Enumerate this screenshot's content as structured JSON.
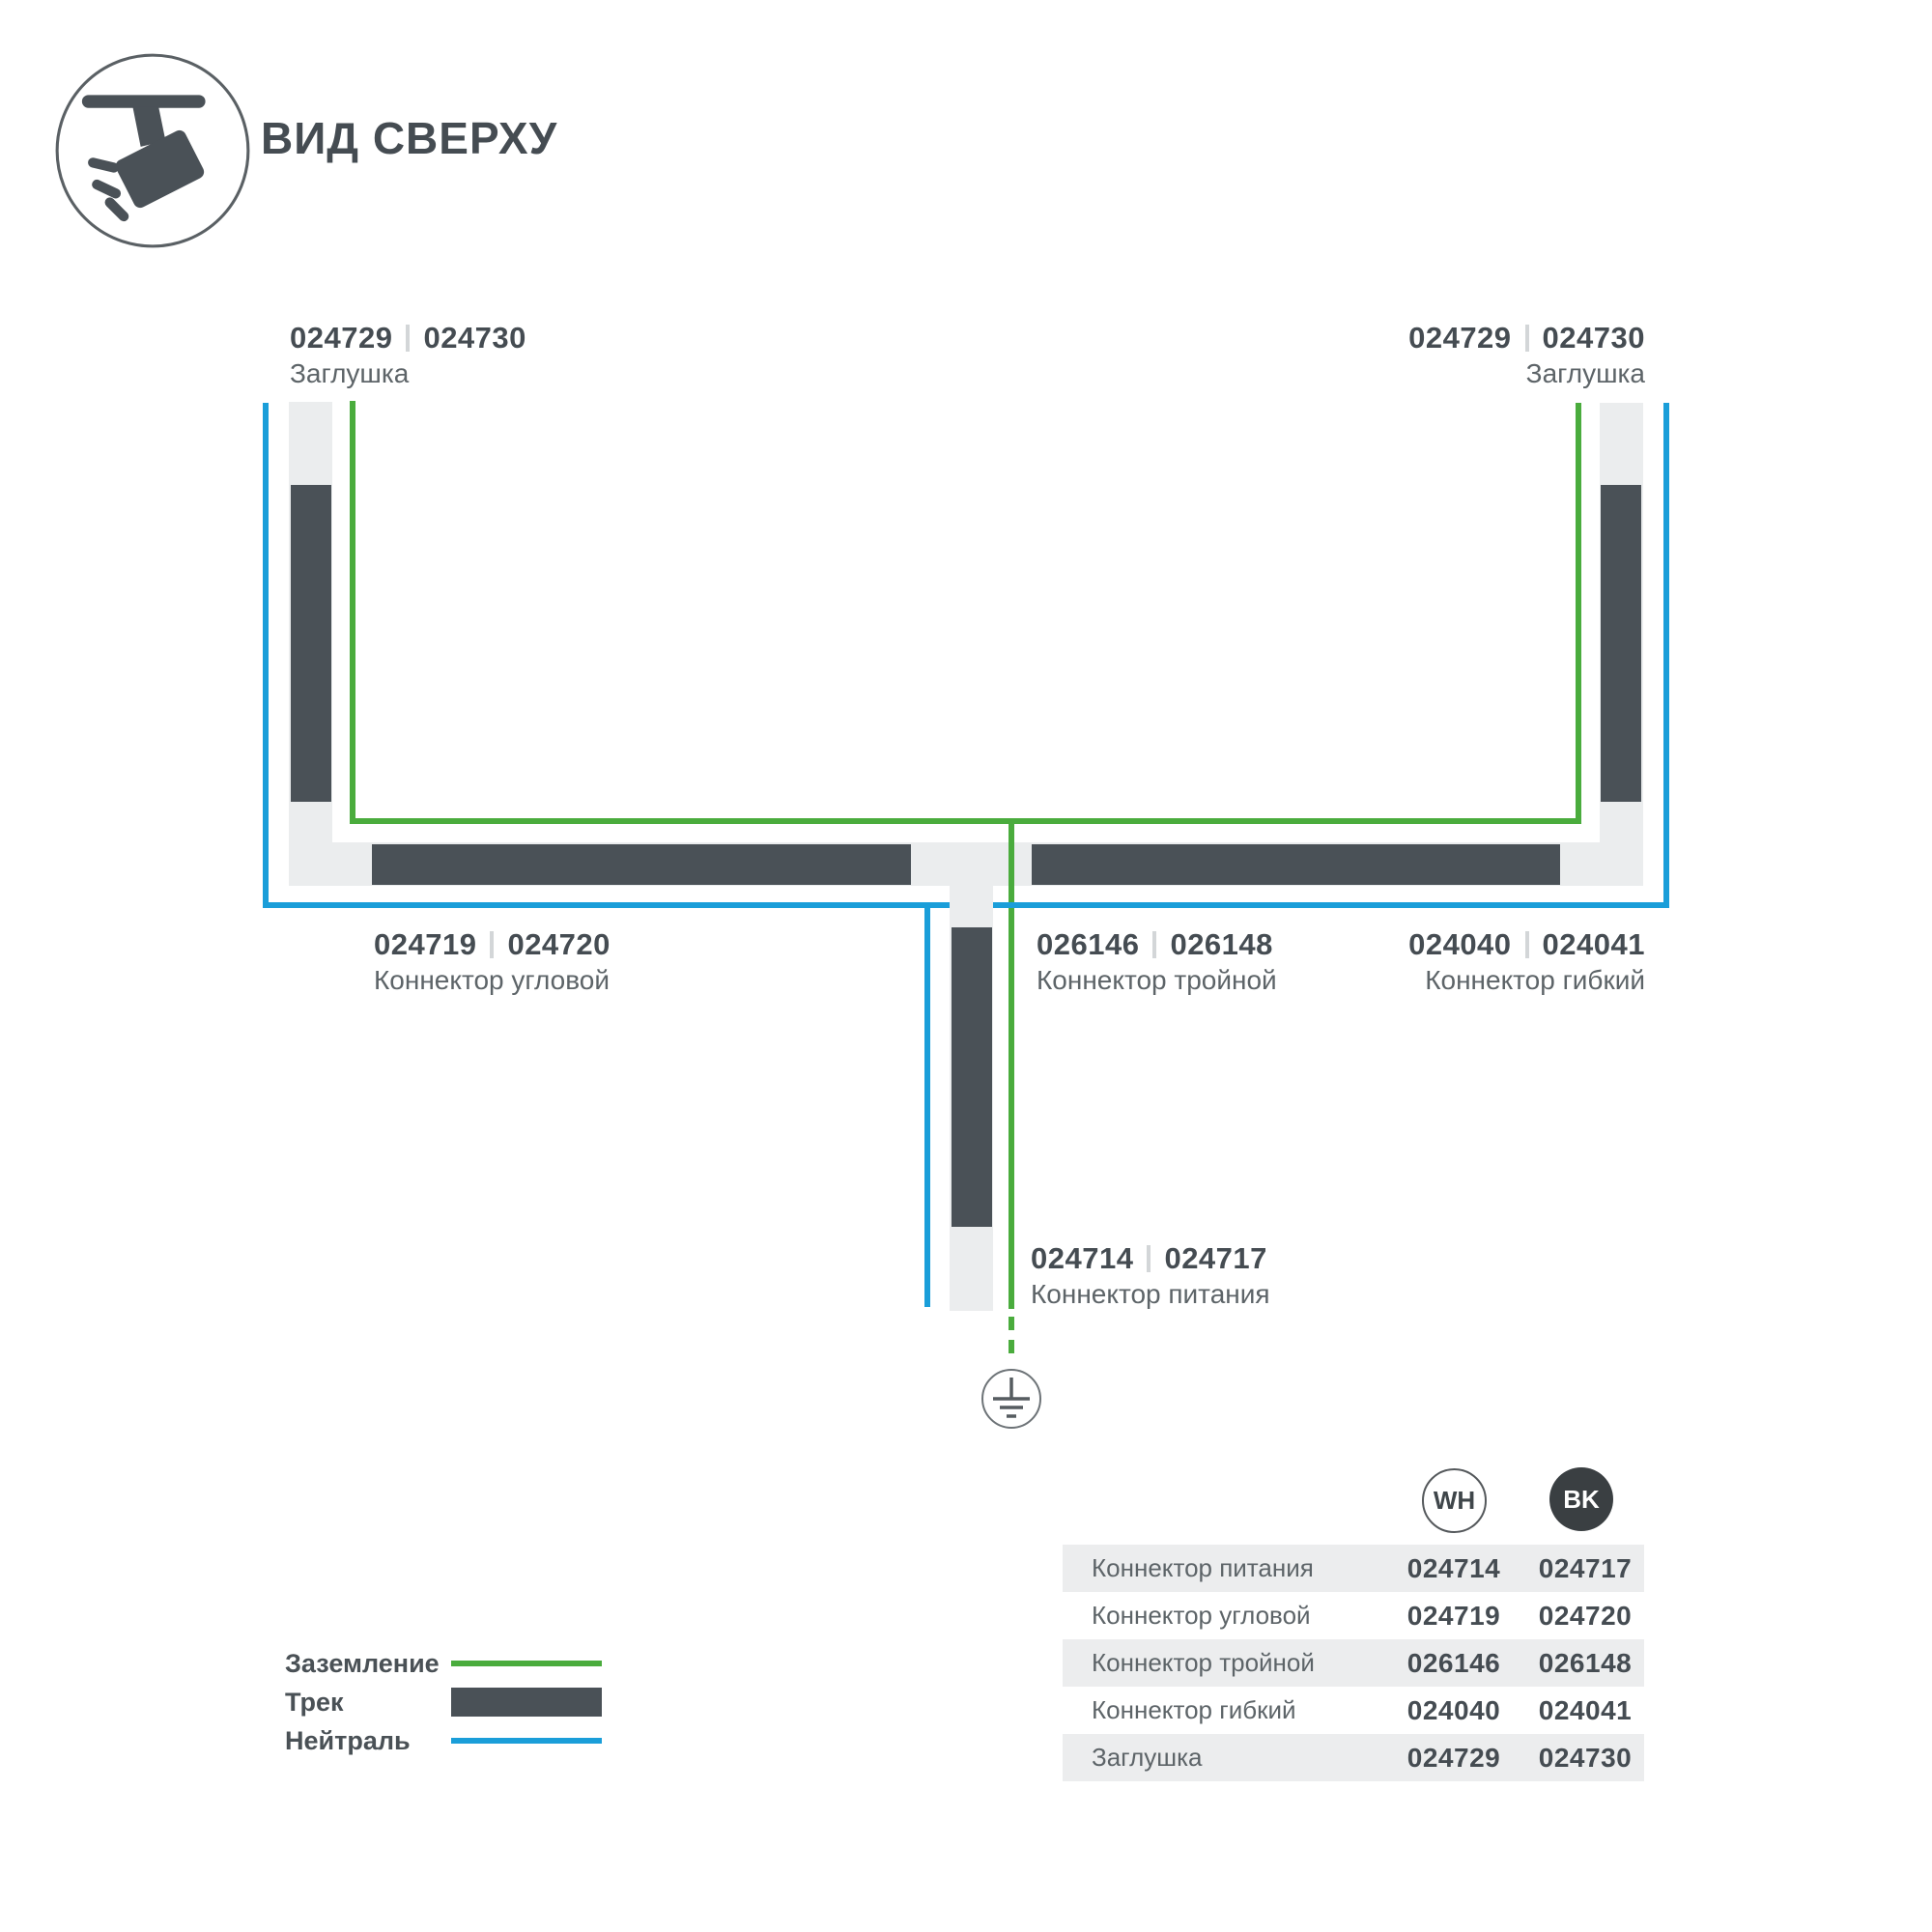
{
  "header": {
    "title": "ВИД СВЕРХУ"
  },
  "diagram": {
    "labels": {
      "cap_left": {
        "num_wh": "024729",
        "num_bk": "024730",
        "name": "Заглушка"
      },
      "cap_right": {
        "num_wh": "024729",
        "num_bk": "024730",
        "name": "Заглушка"
      },
      "corner": {
        "num_wh": "024719",
        "num_bk": "024720",
        "name": "Коннектор угловой"
      },
      "triple": {
        "num_wh": "026146",
        "num_bk": "026148",
        "name": "Коннектор тройной"
      },
      "flexible": {
        "num_wh": "024040",
        "num_bk": "024041",
        "name": "Коннектор гибкий"
      },
      "power": {
        "num_wh": "024714",
        "num_bk": "024717",
        "name": "Коннектор питания"
      }
    }
  },
  "legend": {
    "items": [
      {
        "label": "Заземление",
        "type": "ground-line"
      },
      {
        "label": "Трек",
        "type": "track-bar"
      },
      {
        "label": "Нейтраль",
        "type": "neutral-line"
      }
    ]
  },
  "table": {
    "columns": [
      {
        "code": "WH"
      },
      {
        "code": "BK"
      }
    ],
    "rows": [
      {
        "name": "Коннектор питания",
        "wh": "024714",
        "bk": "024717"
      },
      {
        "name": "Коннектор угловой",
        "wh": "024719",
        "bk": "024720"
      },
      {
        "name": "Коннектор тройной",
        "wh": "026146",
        "bk": "026148"
      },
      {
        "name": "Коннектор гибкий",
        "wh": "024040",
        "bk": "024041"
      },
      {
        "name": "Заглушка",
        "wh": "024729",
        "bk": "024730"
      }
    ]
  },
  "colors": {
    "track_dark": "#4a5157",
    "track_light": "#ebedee",
    "ground_green": "#4aac3d",
    "neutral_blue": "#1a9ed9",
    "text_dark": "#454c52",
    "text_gray": "#5d6468",
    "table_row_gray": "#ecedee",
    "bk_circle": "#3a3f42"
  }
}
